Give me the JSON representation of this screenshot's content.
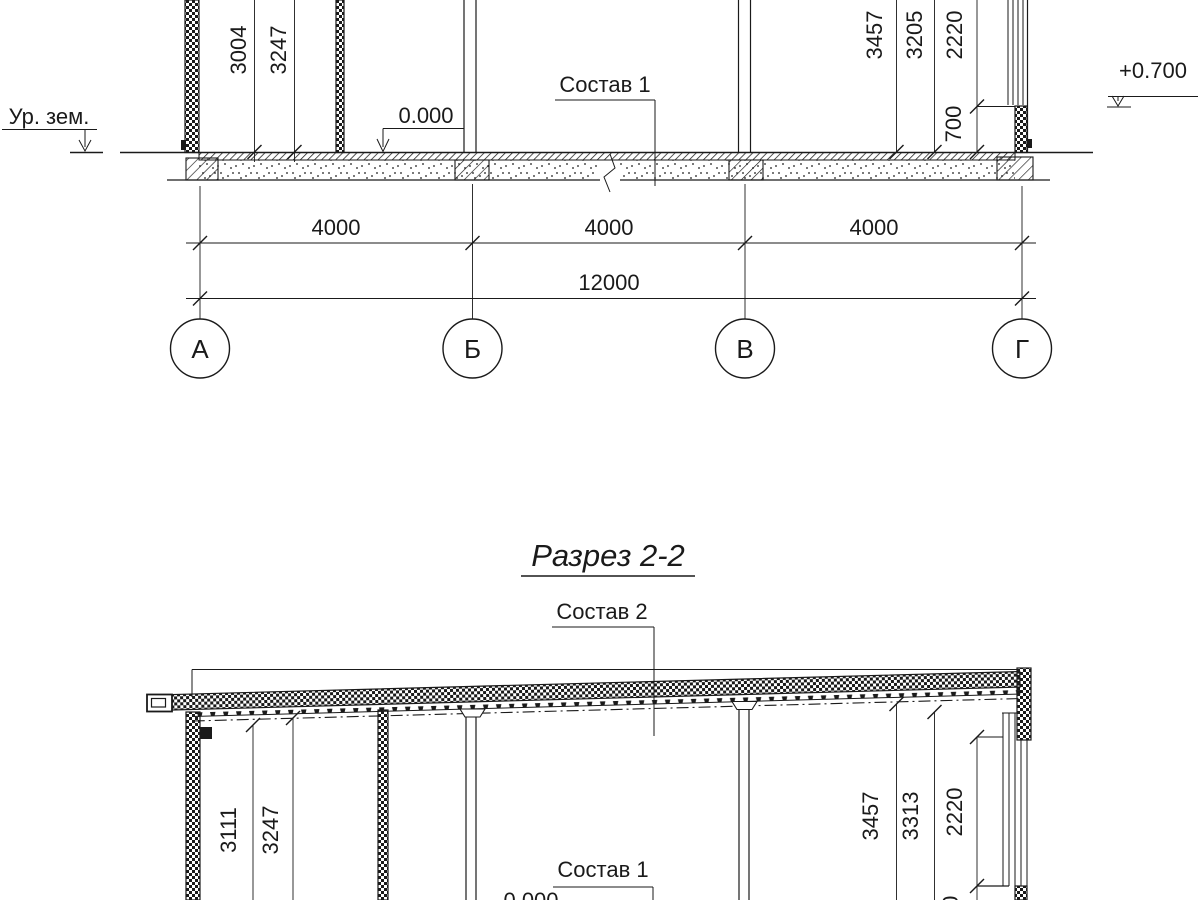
{
  "meta": {
    "background": "#ffffff",
    "ink_color": "#1a1a1a",
    "drawing_type": "building cross-sections"
  },
  "section_top": {
    "ground_level_label": "Ур. зем.",
    "zero_level": "0.000",
    "parapet_level": "+0.700",
    "floor_composition_label": "Состав 1",
    "dim_left_1": "3004",
    "dim_left_2": "3247",
    "dim_right_1": "3457",
    "dim_right_2": "3205",
    "dim_right_3": "2220",
    "dim_right_4": "700",
    "bay_dims": [
      "4000",
      "4000",
      "4000"
    ],
    "total_dim": "12000",
    "axis_labels": [
      "А",
      "Б",
      "В",
      "Г"
    ]
  },
  "section_bottom": {
    "title": "Разрез 2-2",
    "roof_composition_label": "Состав 2",
    "floor_composition_label": "Состав 1",
    "zero_level": "0.000",
    "dim_left_1": "3111",
    "dim_left_2": "3247",
    "dim_right_1": "3457",
    "dim_right_2": "3313",
    "dim_right_3": "2220",
    "dim_right_4": "700"
  }
}
